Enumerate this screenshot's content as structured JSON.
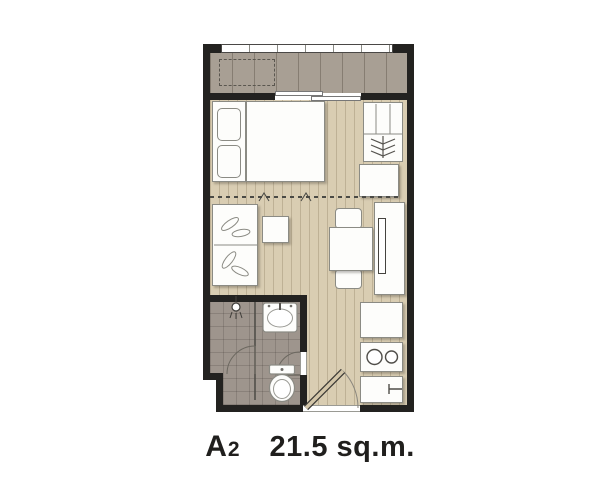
{
  "unit": {
    "code_letter": "A",
    "code_number": "2",
    "area_label": "21.5 sq.m."
  },
  "colors": {
    "bg": "#ffffff",
    "wall": "#232220",
    "floor_main": "#d9cdb2",
    "balcony": "#a89f94",
    "bath_floor": "#9e958d",
    "furniture": "#fdfdfb",
    "outline": "#8b8b84",
    "fixture_line": "#55534e",
    "door_leaf": "#d3c6a9",
    "text": "#201f1d"
  },
  "icons": {
    "clothes_hangers": "stacked chevrons in wardrobe",
    "shower_head": "circle with spray lines",
    "wash_basin": "oval basin in rounded square",
    "toilet": "tank with oval bowl",
    "stove": "two burner circles",
    "kitchen_sink": "square counter with faucet",
    "tv": "thin rectangle on console",
    "air_conditioner_slot": "dashed rectangle on balcony",
    "sliding_door": "offset white panels",
    "door_swing": "quarter-circle arc"
  }
}
